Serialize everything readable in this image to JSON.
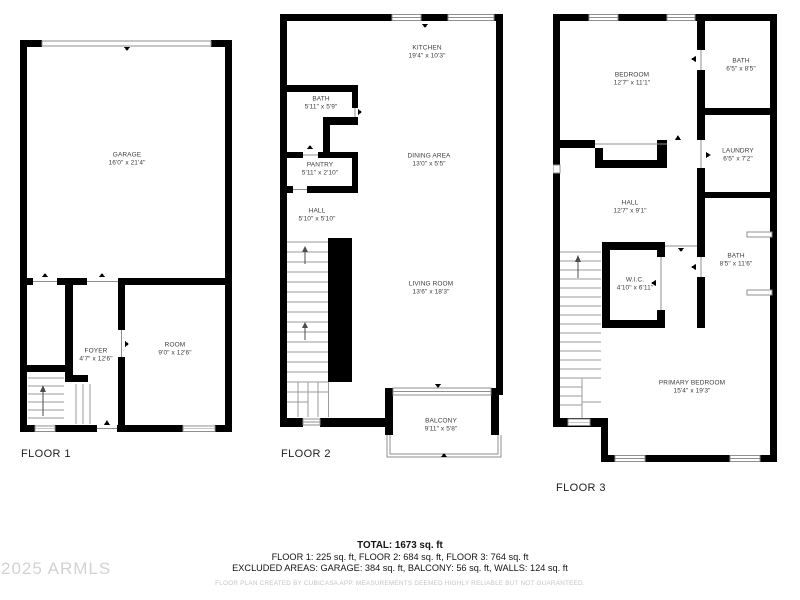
{
  "floors": [
    {
      "label": "FLOOR 1",
      "rooms": [
        {
          "name": "GARAGE",
          "dims": "16'0\" x 21'4\""
        },
        {
          "name": "FOYER",
          "dims": "4'7\" x 12'6\""
        },
        {
          "name": "ROOM",
          "dims": "9'0\" x 12'6\""
        }
      ]
    },
    {
      "label": "FLOOR 2",
      "rooms": [
        {
          "name": "KITCHEN",
          "dims": "19'4\" x 10'3\""
        },
        {
          "name": "BATH",
          "dims": "5'11\" x 5'9\""
        },
        {
          "name": "PANTRY",
          "dims": "5'11\" x 2'10\""
        },
        {
          "name": "DINING AREA",
          "dims": "13'0\" x 5'5\""
        },
        {
          "name": "HALL",
          "dims": "5'10\" x 5'10\""
        },
        {
          "name": "LIVING ROOM",
          "dims": "13'6\" x 18'3\""
        },
        {
          "name": "BALCONY",
          "dims": "9'11\" x 5'8\""
        }
      ]
    },
    {
      "label": "FLOOR 3",
      "rooms": [
        {
          "name": "BEDROOM",
          "dims": "12'7\" x 11'1\""
        },
        {
          "name": "BATH",
          "dims": "6'5\" x 8'5\""
        },
        {
          "name": "LAUNDRY",
          "dims": "6'5\" x 7'2\""
        },
        {
          "name": "HALL",
          "dims": "12'7\" x 9'1\""
        },
        {
          "name": "BATH",
          "dims": "8'5\" x 11'6\""
        },
        {
          "name": "W.I.C.",
          "dims": "4'10\" x 6'11\""
        },
        {
          "name": "PRIMARY BEDROOM",
          "dims": "15'4\" x 19'3\""
        }
      ]
    }
  ],
  "summary": {
    "total": "TOTAL: 1673 sq. ft",
    "floors_line": "FLOOR 1: 225 sq. ft, FLOOR 2: 684 sq. ft, FLOOR 3: 764 sq. ft",
    "excluded_line": "EXCLUDED AREAS: GARAGE: 384 sq. ft, BALCONY: 56 sq. ft, WALLS: 124 sq. ft",
    "disclaimer": "FLOOR PLAN CREATED BY CUBICASA APP. MEASUREMENTS DEEMED HIGHLY RELIABLE BUT NOT GUARANTEED."
  },
  "watermark": "2025 ARMLS",
  "colors": {
    "wall": "#000000",
    "text": "#3c3c3c",
    "thin_line": "#8f8f8f",
    "muted": "#c5c5c5",
    "watermark": "#d2d2d2"
  }
}
